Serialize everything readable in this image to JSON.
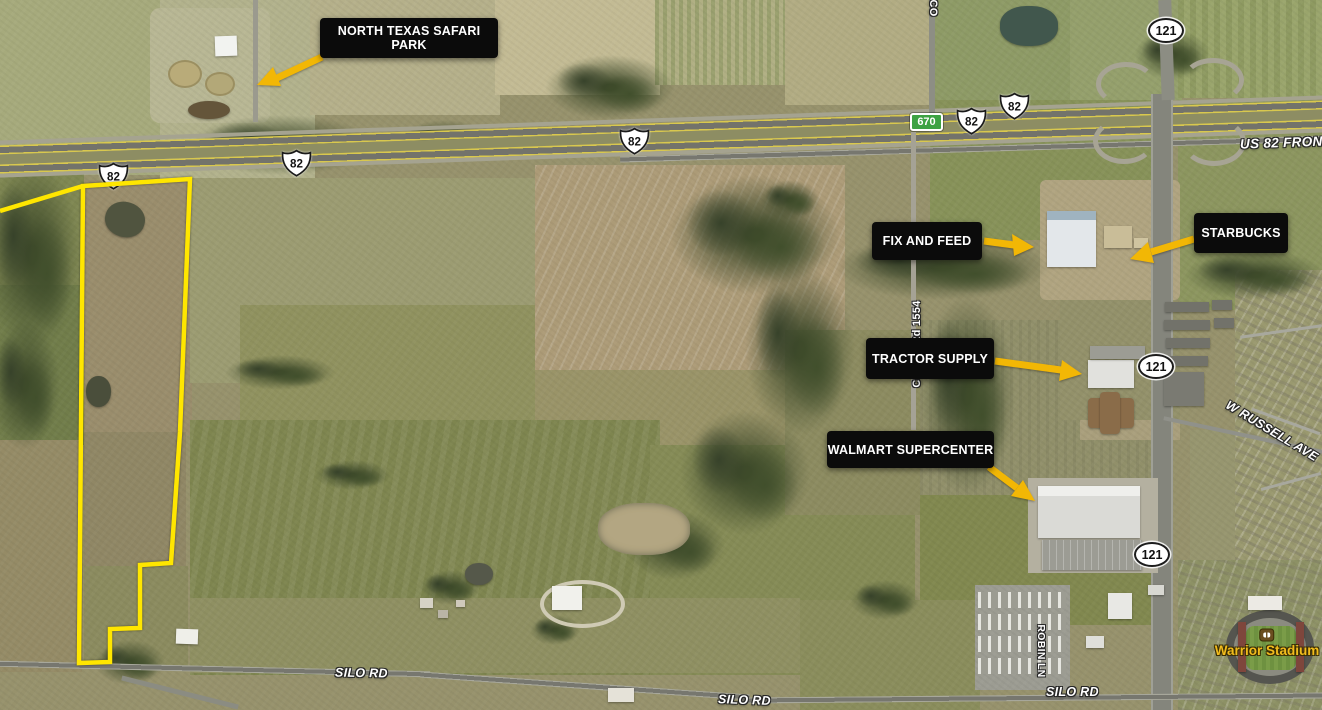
{
  "annotations": [
    {
      "id": "north-texas-safari-park",
      "label": "NORTH TEXAS SAFARI PARK"
    },
    {
      "id": "fix-and-feed",
      "label": "FIX AND FEED"
    },
    {
      "id": "starbucks",
      "label": "STARBUCKS"
    },
    {
      "id": "tractor-supply",
      "label": "TRACTOR SUPPLY"
    },
    {
      "id": "walmart-supercenter",
      "label": "WALMART SUPERCENTER"
    }
  ],
  "roads": {
    "shields": {
      "us_82": "82",
      "sh_121": "121",
      "cr_670": "670"
    },
    "labels": {
      "us_82_frontage": "US 82 FRONT",
      "silo_rd": "SILO RD",
      "w_russell_ave": "W RUSSELL AVE",
      "county_rd_1554": "County Rd 1554",
      "robin_ln": "ROBIN LN",
      "county_rd_partial": "CO"
    }
  },
  "pois": {
    "warrior_stadium": "Warrior Stadium"
  },
  "parcel": {
    "outline_color": "#FFE600"
  },
  "colors": {
    "arrow": "#F2B705",
    "annotation_bg": "#0B0B0B",
    "annotation_text": "#FFFFFF",
    "green_shield": "#3DA243"
  }
}
